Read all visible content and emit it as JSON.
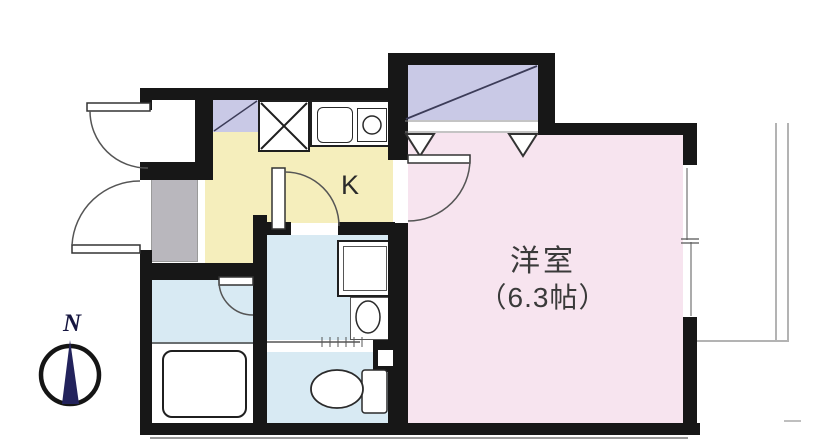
{
  "floorplan": {
    "western_room": {
      "name_label": "洋室",
      "size_label": "（6.3帖）"
    },
    "kitchen": {
      "label": "K"
    },
    "compass": {
      "label": "N"
    },
    "colors": {
      "wall": "#171717",
      "western_room_fill": "#f7e4ef",
      "kitchen_fill": "#f5eebc",
      "wet_area_fill": "#d8eaf3",
      "closet_fill": "#c9c9e6",
      "entry_fill": "#b9b7bd",
      "compass_needle": "#23235c",
      "line_gray": "#9a9a9a"
    },
    "fixtures": [
      "entry-door",
      "storage-door",
      "kitchen-door",
      "room-door",
      "bath-door",
      "sliding-door",
      "refrigerator-space",
      "range-space",
      "kitchen-sink",
      "stove-burner",
      "closet",
      "washing-machine-pan",
      "wash-basin",
      "bathtub",
      "toilet",
      "window",
      "balcony-railing",
      "compass"
    ]
  }
}
